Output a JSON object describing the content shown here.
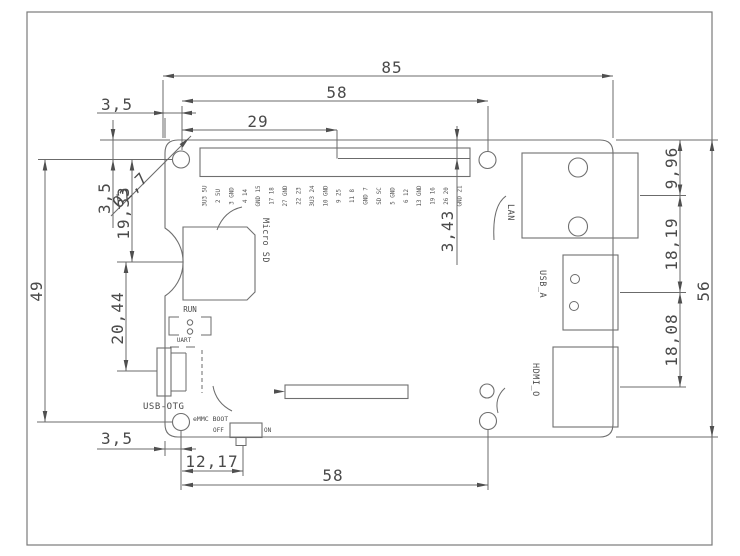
{
  "drawing": {
    "dims": {
      "total_width": "85",
      "hole_span_top": "58",
      "header_offset_x": "29",
      "hole_offset_left_top": "3,5",
      "hole_offset_top": "3,5",
      "hole_diameter": "Ø2,7",
      "hole_to_notch": "19,33",
      "notch_to_usb": "20,44",
      "hole_span_left": "49",
      "hole_offset_left_bottom": "3,5",
      "hole_to_switch": "12,17",
      "hole_span_bottom": "58",
      "top_to_lan": "9,96",
      "lan_to_usba": "18,19",
      "usba_to_hdmi": "18,08",
      "total_height": "56",
      "edge_to_pin_row": "3,43"
    },
    "labels": {
      "micro_sd": "Micro SD",
      "run": "RUN",
      "uart": "UART",
      "usb_otg": "USB-OTG",
      "emmc_boot": "eMMC BOOT",
      "off": "OFF",
      "on": "ON",
      "lan": "LAN",
      "usb_a": "USB_A",
      "hdmi": "HDMI_O"
    },
    "gpio_pin_labels": [
      "3U3 5U",
      "2 5U",
      "3 GND",
      "4 14",
      "GND 15",
      "17 18",
      "27 GND",
      "22 23",
      "3U3 24",
      "10 GND",
      "9 25",
      "11 8",
      "GND 7",
      "SD SC",
      "5 GND",
      "6 12",
      "13 GND",
      "19 16",
      "26 20",
      "GND 21"
    ]
  }
}
